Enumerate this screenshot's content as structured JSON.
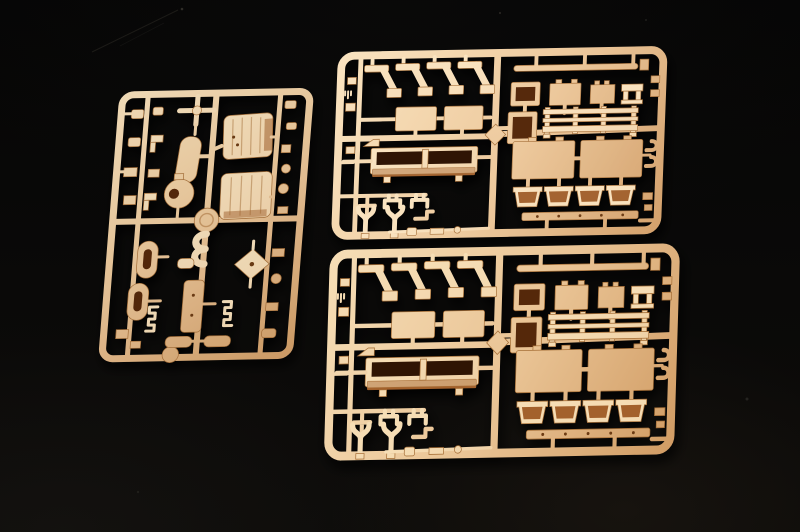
{
  "scene": {
    "type": "photograph",
    "subject": "Three tan injection-molded model kit sprues on a black background",
    "background_color": "#050505",
    "colors": {
      "plastic_light": "#f5e0bd",
      "plastic_mid": "#e8c59a",
      "plastic_dark": "#cf9d69",
      "plastic_edge": "#a5713d",
      "cavity_dark": "#2e1404",
      "cavity_mid": "#54280c",
      "cavity_warm": "#a16230",
      "background": "#050505"
    },
    "sprues": [
      {
        "name": "left-sprue",
        "position": "left side, tilted counter-clockwise",
        "contents": "engine blocks, cylinder, ball mount, cross shaft, capsule links, figure-3 pipe, diamond bracket, small fittings"
      },
      {
        "name": "upper-right-sprue",
        "position": "upper right",
        "contents": "four fender brackets, hatch panels, open boxes, slatted bench rail, long open tray, wishbone hooks, four buckets, thin rails"
      },
      {
        "name": "lower-right-sprue",
        "position": "lower right, duplicate of upper-right sprue",
        "contents": "four fender brackets, hatch panels, open boxes, slatted bench rail, long open tray, wishbone hooks, four buckets, thin rails"
      }
    ]
  }
}
